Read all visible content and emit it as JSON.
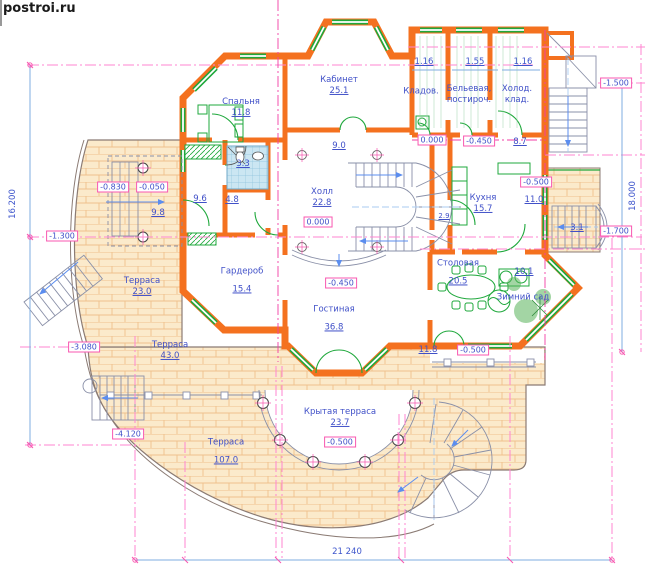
{
  "brand": {
    "logo": "postroi.ru"
  },
  "rooms": {
    "bedroom": {
      "name": "Спальня",
      "area": "11.8"
    },
    "cabinet": {
      "name": "Кабинет",
      "area": "25.1"
    },
    "storage": {
      "name": "Кладов."
    },
    "linen": {
      "name": "Бельевая,",
      "name2": "постироч."
    },
    "cold_storage": {
      "name": "Холод.",
      "name2": "клад."
    },
    "hall": {
      "name": "Холл",
      "area": "22.8"
    },
    "kitchen": {
      "name": "Кухня",
      "area": "15.7"
    },
    "wardrobe": {
      "name": "Гардероб",
      "area": "15.4"
    },
    "dining": {
      "name": "Столовая",
      "area": "20.5"
    },
    "winter_garden": {
      "name": "Зимний сад",
      "area": "10.1"
    },
    "living": {
      "name": "Гостиная",
      "area": "36.8"
    },
    "terrace_left": {
      "name": "Терраса",
      "area": "23.0"
    },
    "terrace_mid": {
      "name": "Терраса",
      "area": "43.0"
    },
    "terrace_big": {
      "name": "Терраса",
      "area": "107.0"
    },
    "covered_terrace": {
      "name": "Крытая терраса",
      "area": "23.7"
    }
  },
  "areas": {
    "corridor_top": "9.0",
    "hall_right": "8.7",
    "bath": "3.3",
    "room_left": "9.6",
    "vestibule": "9.8",
    "corridor_left": "4.8",
    "pantry": "2.9",
    "terrace_kitchen": "11.0",
    "stair_kitchen": "3.1",
    "walkway": "11.8"
  },
  "levels": {
    "zero_top": "0.000",
    "zero_hall": "0.000",
    "m045_top": "-0.450",
    "m045_living": "-0.450",
    "m050_terrace": "-0.500",
    "m050_walk": "-0.500",
    "m050_colonnade": "-0.500",
    "m083_porch": "-0.830",
    "m005_porch": "-0.050",
    "m130_left": "-1.300",
    "m150_stair": "-1.500",
    "m170_right": "-1.700",
    "m308_terrace": "-3.080",
    "m412_terrace": "-4.120"
  },
  "dimensions": {
    "left_total": "16.200",
    "right_total": "18.000",
    "bottom_total": "21 240",
    "win1": "1.16",
    "win2": "1.55",
    "win3": "1.16"
  },
  "colors": {
    "wall": "#F4711F",
    "glazing": "#1FA83C",
    "label_text": "#4050C8",
    "level_box": "#F857B0",
    "construction_line": "#FF85D2",
    "dimension_line": "#7FAEE0",
    "brick": "#FBEACB",
    "stair": "#8A90A8"
  }
}
